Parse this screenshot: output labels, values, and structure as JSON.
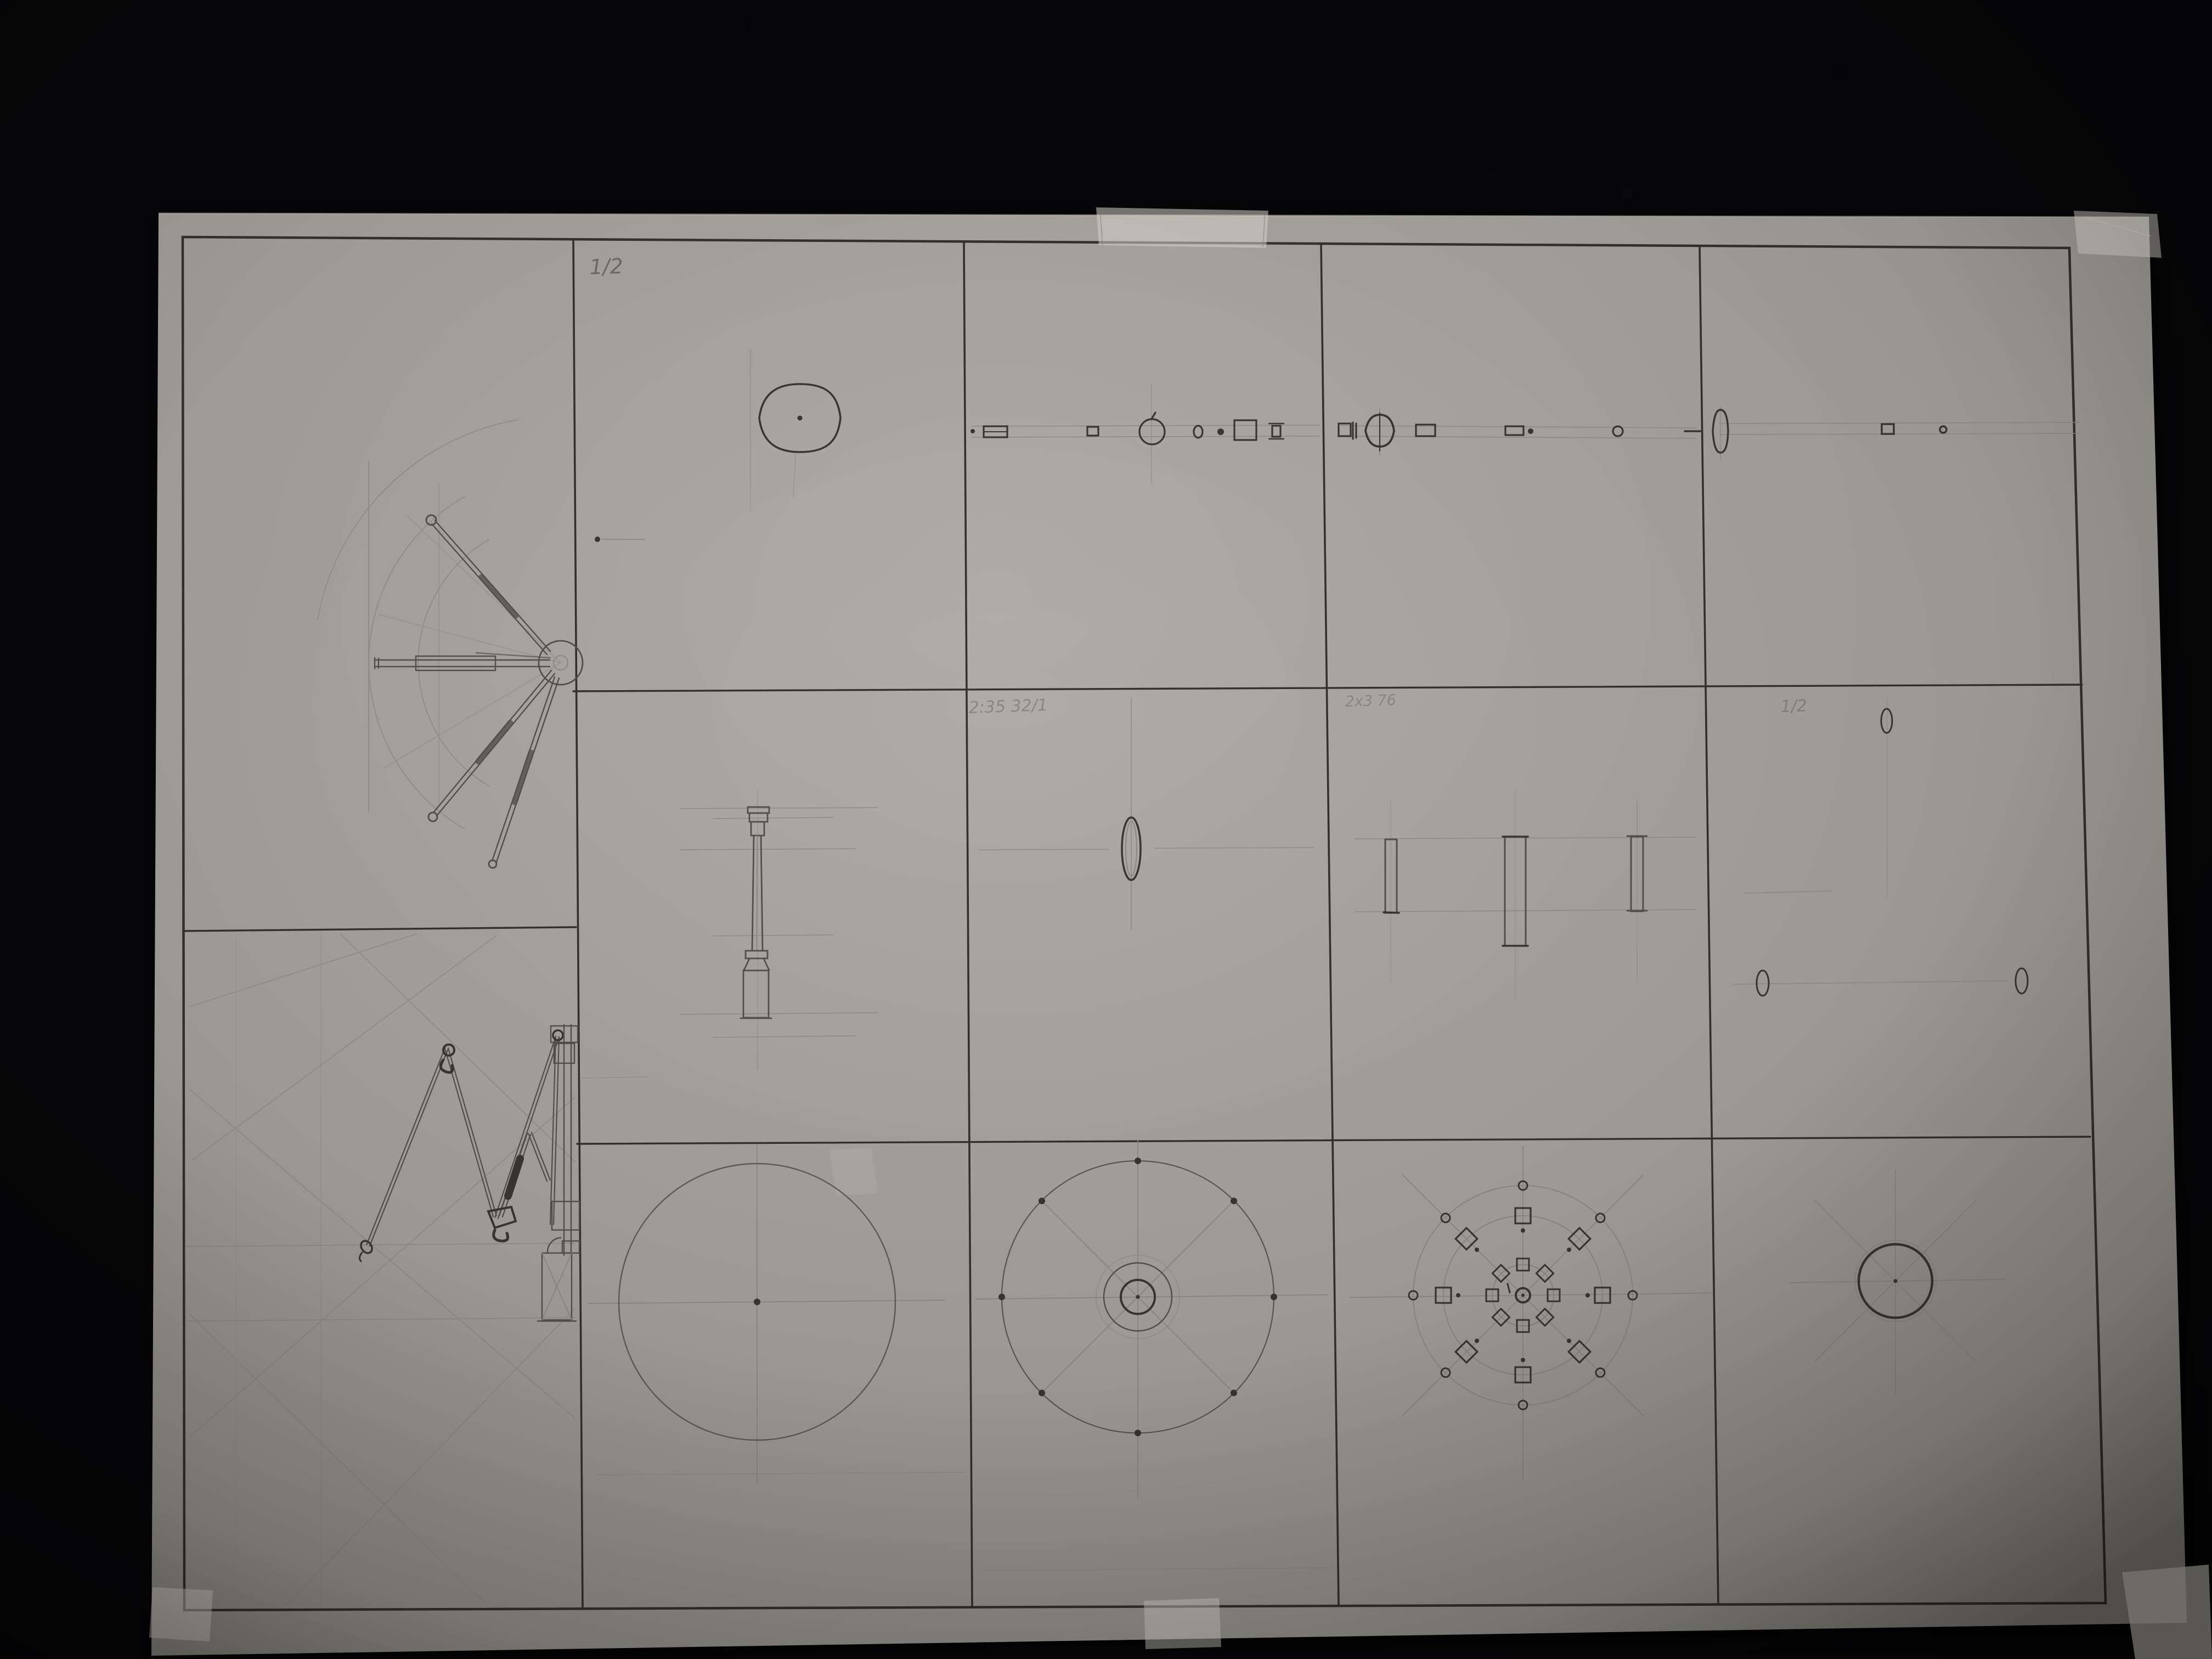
{
  "colors": {
    "background": "#070709",
    "paper": "#a7a49e",
    "ink": "#34322e",
    "pencil_dark": "#3a3733",
    "pencil_medium": "#55524c",
    "pencil_faint": "#8f8c86",
    "handwriting": "#6f6c66",
    "tape": "#d9d6ce"
  },
  "sheet": {
    "annotations": {
      "top_sheet_number": "1/2",
      "panel_row2_col3_note": "2:35 32/1",
      "panel_row2_col4_note": "2x3 76",
      "panel_row2_col5_note": "1/2"
    },
    "panels": {
      "col1_top": "umbrella-mechanism-deployed-elevation",
      "col1_bottom": "umbrella-mechanism-folded-elevation",
      "row1": "canopy-deployment-sequence-side-views",
      "row2": "mast-and-ring-detail-views",
      "row3": "canopy-plan-views"
    }
  }
}
